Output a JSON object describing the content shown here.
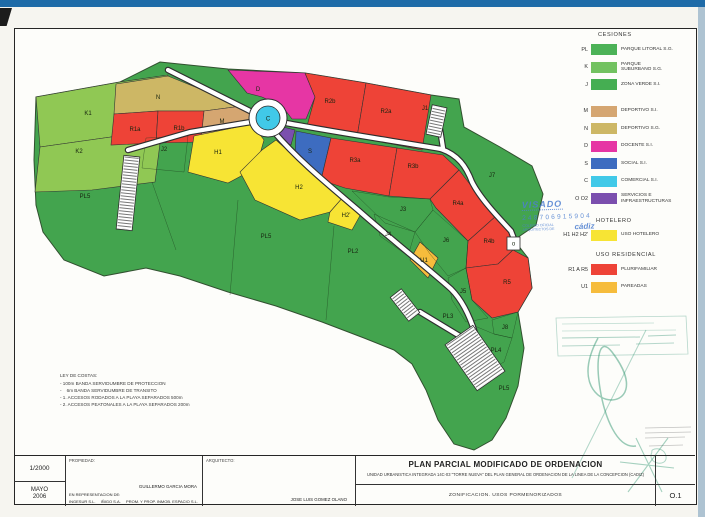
{
  "scan": {
    "top_bar_color": "#1e6ba8",
    "right_strip_color": "#aec3d2",
    "corner_tab_color": "#1c1c1c"
  },
  "map": {
    "colors": {
      "green": "#43a44e",
      "lgreen": "#90c854",
      "khaki": "#cdb765",
      "tan": "#d5a671",
      "red": "#ee4337",
      "magenta": "#e636a4",
      "blue": "#3d6cc0",
      "cyan": "#41c9e8",
      "purple": "#7b4fae",
      "yellow": "#f7e434",
      "orange": "#f6bc3c"
    },
    "outline": "36,97 120,82 160,62 228,69 305,73 366,83 431,95 459,99 464,127 500,147 532,166 543,194 536,225 514,240 528,258 532,288 518,312 524,348 518,386 506,418 492,440 474,450 454,444 438,420 426,390 412,364 394,350 364,338 322,322 276,306 228,292 180,276 146,268 104,276 64,260 43,232 36,205 34,160",
    "parcels": [
      {
        "id": "k1",
        "color": "lgreen",
        "pts": "36,97 120,82 168,75 162,128 118,136 40,147"
      },
      {
        "id": "k2",
        "color": "lgreen",
        "pts": "40,147 118,136 162,128 155,182 92,190 35,192"
      },
      {
        "id": "n",
        "color": "khaki",
        "pts": "116,84 168,76 242,106 204,111 158,111 114,114"
      },
      {
        "id": "r1a",
        "color": "red",
        "pts": "114,114 158,111 156,143 111,145"
      },
      {
        "id": "r1b",
        "color": "red",
        "pts": "158,111 204,111 201,142 156,143"
      },
      {
        "id": "m",
        "color": "tan",
        "pts": "204,111 242,106 254,114 249,130 226,136 201,140"
      },
      {
        "id": "d",
        "color": "magenta",
        "pts": "228,70 305,73 315,97 306,119 292,119 282,106 262,97 247,93"
      },
      {
        "id": "r2b",
        "color": "red",
        "pts": "305,73 366,83 357,137 307,126 315,97"
      },
      {
        "id": "r2a",
        "color": "red",
        "pts": "366,83 431,95 422,150 357,137"
      },
      {
        "id": "o2",
        "color": "purple",
        "pts": "279,126 295,130 291,145 276,138"
      },
      {
        "id": "s",
        "color": "blue",
        "pts": "296,131 331,138 321,180 295,157"
      },
      {
        "id": "r3a",
        "color": "red",
        "pts": "331,138 397,148 389,196 345,188 321,180"
      },
      {
        "id": "r3b",
        "color": "red",
        "pts": "397,148 443,155 459,170 430,199 389,196"
      },
      {
        "id": "r4a",
        "color": "red",
        "pts": "459,170 479,196 496,216 468,241 436,208 430,199"
      },
      {
        "id": "r4b",
        "color": "red",
        "pts": "496,216 511,234 513,250 498,264 466,268 468,241"
      },
      {
        "id": "r5",
        "color": "red",
        "pts": "466,268 498,264 513,250 528,258 532,288 518,312 492,318 472,300"
      },
      {
        "id": "h1",
        "color": "yellow",
        "pts": "194,136 252,124 264,140 256,168 228,183 188,172"
      },
      {
        "id": "h2",
        "color": "yellow",
        "pts": "240,172 262,150 276,140 296,158 320,181 344,196 330,212 300,220 255,200"
      },
      {
        "id": "h2-prime",
        "color": "yellow",
        "pts": "344,196 362,212 352,230 328,222 330,212"
      },
      {
        "id": "u1",
        "color": "orange",
        "pts": "420,242 438,258 428,278 410,260"
      }
    ],
    "boundaries": [
      "146,138 188,136 184,172 142,168 146,138",
      "352,191 389,197 430,199 433,210 415,232 385,223 352,191",
      "374,214 415,232 408,256 380,236 374,214",
      "415,232 433,210 468,241 466,268 448,276 430,254 415,232",
      "448,278 466,268 472,300 488,318 466,322 452,300 448,278",
      "492,320 518,312 512,338 494,334 492,320",
      "470,324 494,334 512,338 504,362 486,372 470,350 470,324",
      "152,182 176,250",
      "238,200 230,295",
      "334,226 326,320"
    ],
    "roads": [
      "M168,70 L252,112",
      "M286,123 C340,133 400,142 441,149",
      "M441,149 C458,155 466,166 472,182 C480,198 497,216 511,231 L516,244",
      "M443,148 L437,110",
      "M274,132 C300,162 330,186 358,210 C392,240 425,266 451,289 C462,300 470,317 475,333",
      "M251,122 L190,132 L128,150",
      "M420,312 L463,338"
    ],
    "parkings": [
      {
        "x": 429,
        "y": 106,
        "w": 15,
        "h": 30,
        "rot": 12
      },
      {
        "x": 120,
        "y": 156,
        "w": 16,
        "h": 74,
        "rot": 6
      },
      {
        "x": 398,
        "y": 290,
        "w": 14,
        "h": 30,
        "rot": -38
      },
      {
        "x": 458,
        "y": 330,
        "w": 34,
        "h": 56,
        "rot": -35
      }
    ],
    "roundabout": {
      "cx": 268,
      "cy": 118,
      "r_outer": 19,
      "r_inner": 12,
      "label": "C"
    },
    "utility_square": {
      "x": 507,
      "y": 237,
      "size": 13,
      "label": "o"
    },
    "labels": [
      {
        "t": "K1",
        "x": 88,
        "y": 115
      },
      {
        "t": "K2",
        "x": 79,
        "y": 153
      },
      {
        "t": "PL5",
        "x": 85,
        "y": 198
      },
      {
        "t": "N",
        "x": 158,
        "y": 99
      },
      {
        "t": "R1a",
        "x": 135,
        "y": 131
      },
      {
        "t": "R1b",
        "x": 179,
        "y": 130
      },
      {
        "t": "M",
        "x": 222,
        "y": 123
      },
      {
        "t": "D",
        "x": 258,
        "y": 91
      },
      {
        "t": "R2b",
        "x": 330,
        "y": 103
      },
      {
        "t": "R2a",
        "x": 386,
        "y": 113
      },
      {
        "t": "J1",
        "x": 425,
        "y": 110
      },
      {
        "t": "S",
        "x": 310,
        "y": 153
      },
      {
        "t": "R3a",
        "x": 355,
        "y": 162
      },
      {
        "t": "R3b",
        "x": 413,
        "y": 168
      },
      {
        "t": "R4a",
        "x": 458,
        "y": 205
      },
      {
        "t": "R4b",
        "x": 489,
        "y": 243
      },
      {
        "t": "J7",
        "x": 492,
        "y": 177
      },
      {
        "t": "J2",
        "x": 164,
        "y": 151
      },
      {
        "t": "H1",
        "x": 218,
        "y": 154
      },
      {
        "t": "H2",
        "x": 299,
        "y": 189
      },
      {
        "t": "H2'",
        "x": 346,
        "y": 217
      },
      {
        "t": "J3",
        "x": 403,
        "y": 211
      },
      {
        "t": "J4",
        "x": 388,
        "y": 236
      },
      {
        "t": "J6",
        "x": 446,
        "y": 242
      },
      {
        "t": "U1",
        "x": 424,
        "y": 262
      },
      {
        "t": "R5",
        "x": 507,
        "y": 284
      },
      {
        "t": "J5",
        "x": 463,
        "y": 293
      },
      {
        "t": "J8",
        "x": 505,
        "y": 329
      },
      {
        "t": "PL3",
        "x": 448,
        "y": 318
      },
      {
        "t": "PL4",
        "x": 496,
        "y": 352
      },
      {
        "t": "PL5",
        "x": 504,
        "y": 390
      },
      {
        "t": "PL2",
        "x": 353,
        "y": 253
      },
      {
        "t": "PL5",
        "x": 266,
        "y": 238
      }
    ]
  },
  "legend": {
    "sections": [
      {
        "header": "CESIONES",
        "indent": 46,
        "gap_top": 0,
        "rows": [
          {
            "code": "PL",
            "color": "#4cb257",
            "label": "PARQUE LITORAL S.G."
          },
          {
            "code": "K",
            "color": "#72c260",
            "label": "PARQUE\nSUBURBANO S.G."
          },
          {
            "code": "J",
            "color": "#45ae52",
            "label": "ZONA VERDE S.I."
          },
          {
            "code": "M",
            "color": "#d5a671",
            "label": "DEPORTIVO S.I.",
            "gap": 9
          },
          {
            "code": "N",
            "color": "#cdb765",
            "label": "DEPORTIVO S.G."
          },
          {
            "code": "D",
            "color": "#e636a4",
            "label": "DOCENTE S.I."
          },
          {
            "code": "S",
            "color": "#3d6cc0",
            "label": "SOCIAL S.I."
          },
          {
            "code": "C",
            "color": "#41c9e8",
            "label": "COMERCIAL S.I."
          },
          {
            "code": "O O2",
            "color": "#7b4fae",
            "label": "SERVICIOS E\nINFRAESTRUCTURAS"
          }
        ]
      },
      {
        "header": "HOTELERO",
        "indent": 44,
        "gap_top": 10,
        "rows": [
          {
            "code": "H1 H2 H2'",
            "color": "#f7e434",
            "label": "USO HOTELERO"
          }
        ]
      },
      {
        "header": "USO RESIDENCIAL",
        "indent": 44,
        "gap_top": 8,
        "rows": [
          {
            "code": "R1 A R5",
            "color": "#ee4337",
            "label": "PLURIFAMILIAR"
          },
          {
            "code": "U1",
            "color": "#f6bc3c",
            "label": "PAREADAS"
          }
        ]
      }
    ]
  },
  "visado": {
    "word": "VISADO",
    "number": "248706915904",
    "org_small": "COLEGIO OFICIAL ARQUITECTOS DE",
    "org_big": "cádiz"
  },
  "ley": {
    "title": "LEY DE COSTAS:",
    "lines": [
      "- 100m BANDA SERVIDUMBRE DE PROTECCION",
      "-    6m BANDA SERVIDUMBRE DE TRANSITO",
      "- 1. ACCESOS RODADOS A LA PLAYA SEPARADOS 500m",
      "- 2. ACCESOS PEATONALES A LA PLAYA SEPARADOS 200m"
    ]
  },
  "titleblock": {
    "scale": "1/2000",
    "month": "MAYO",
    "year": "2006",
    "propiedad_label": "PROPIEDAD:",
    "propiedad_name": "GUILLERMO GARCIA MORA",
    "propiedad_rep": "EN REPRESENTACION DE:",
    "companies": [
      "INGESUR S.L.",
      "IÑIGO S.A.",
      "PROM. Y PROP. INMOB. ESPACIO S.L."
    ],
    "arquitecto_label": "ARQUITECTO:",
    "arquitecto_name": "JOSE LUIS GOMEZ OLANO",
    "title": "PLAN PARCIAL MODIFICADO DE ORDENACION",
    "subtitle": "UNIDAD URBANISTICA INTEGRADA 14C-03 \"TORRE NUEVA\" DEL PLAN GENERAL DE ORDENACION DE LA LINEA DE LA CONCEPCION (CADIZ)",
    "sheet_title": "ZONIFICACION. USOS PORMENORIZADOS",
    "sheet_number": "O.1"
  },
  "stamps": [
    {
      "d": "M556,318 L686,316 L688,354 L558,356 Z",
      "s": "rgba(20,130,95,0.30)",
      "w": 0.8
    },
    {
      "d": "M562,324 L654,323",
      "s": "rgba(20,130,95,0.25)",
      "w": 0.8
    },
    {
      "d": "M562,331 L676,330",
      "s": "rgba(20,130,95,0.25)",
      "w": 0.8
    },
    {
      "d": "M562,338 L640,337 M648,336 L676,335",
      "s": "rgba(20,130,95,0.35)",
      "w": 1.0
    },
    {
      "d": "M562,346 L620,345 M636,344 L674,343",
      "s": "rgba(20,130,95,0.3)",
      "w": 0.9
    },
    {
      "d": "M598,338 C556,416 664,420 612,352 C586,318 598,452 636,446",
      "s": "rgba(30,140,100,0.45)",
      "w": 1.5
    },
    {
      "d": "M646,330 L572,478",
      "s": "rgba(30,140,100,0.35)",
      "w": 1.0
    },
    {
      "d": "M628,492 L668,438 M636,438 L662,492 M620,462 L674,468",
      "s": "rgba(30,140,100,0.4)",
      "w": 1.1
    },
    {
      "d": "M645,428 L691,427 M645,433 L691,432 M645,438 L685,437 M649,446 L683,445",
      "s": "rgba(60,60,60,0.3)",
      "w": 0.7
    },
    {
      "d": "M652,452 C646,464 668,468 666,456 C664,446 650,448 652,452",
      "s": "rgba(30,140,100,0.35)",
      "w": 1.0
    }
  ]
}
